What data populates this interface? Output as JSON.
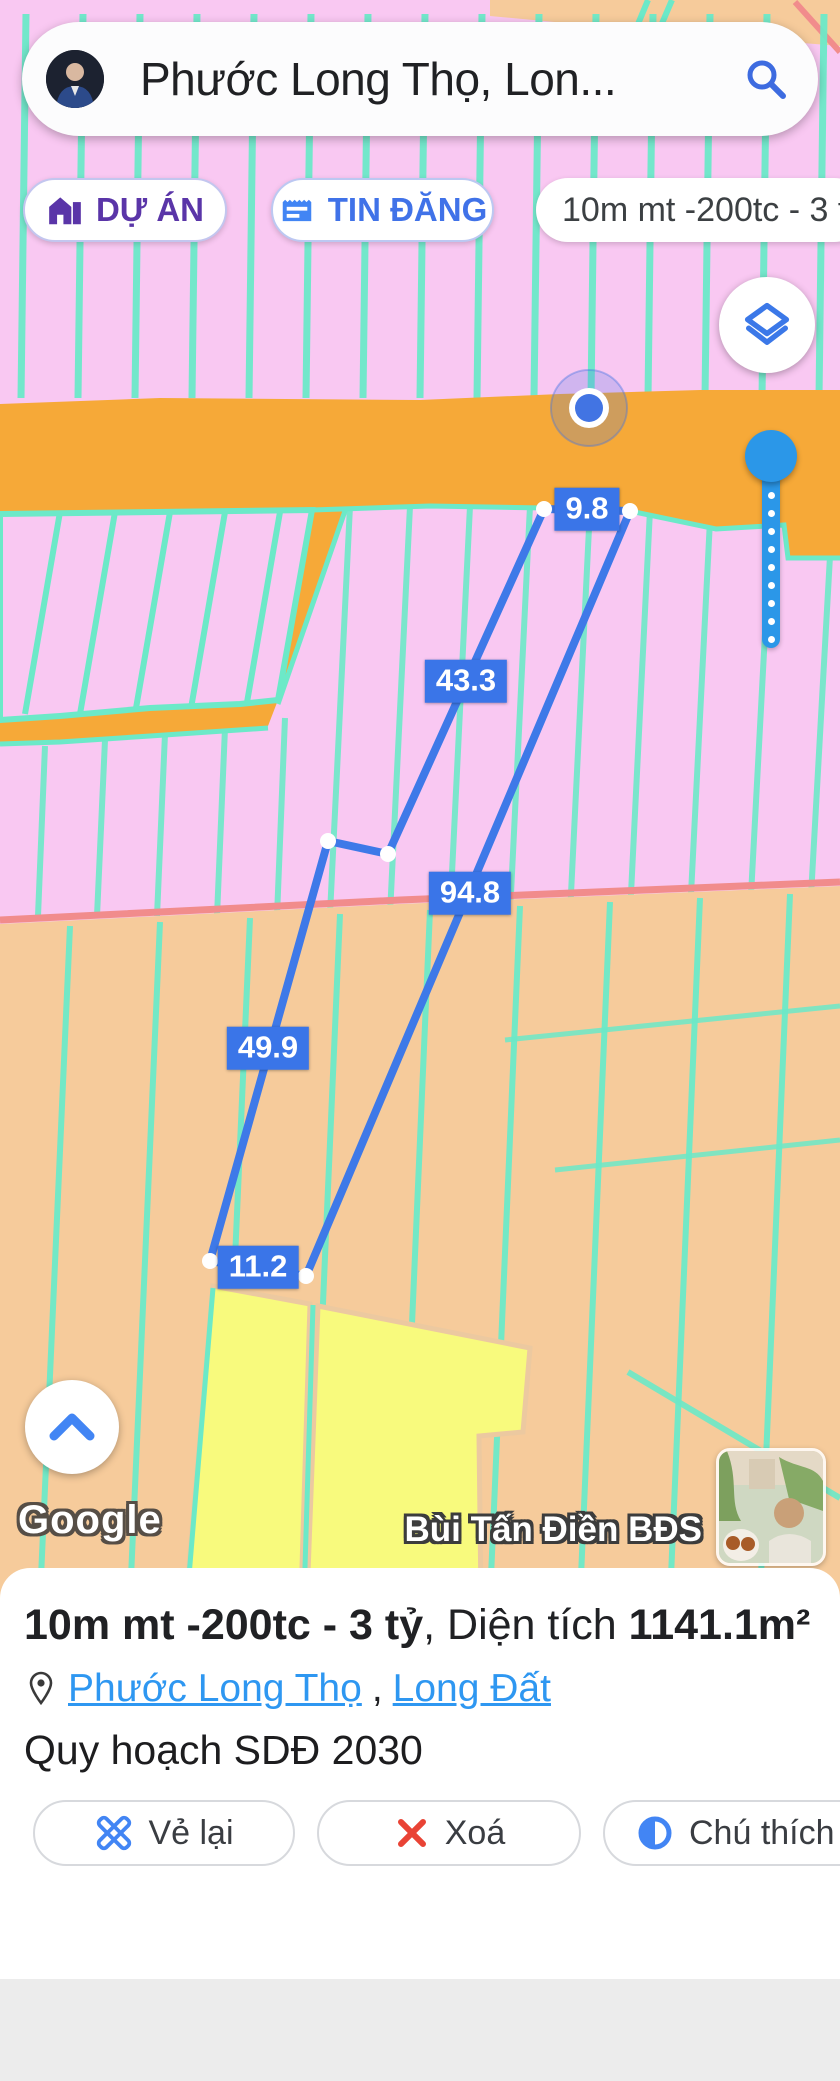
{
  "search": {
    "query": "Phước Long Thọ, Lon..."
  },
  "chips": {
    "project": {
      "label": "DỰ ÁN"
    },
    "listings": {
      "label": "TIN ĐĂNG"
    },
    "listing_info": {
      "label": "10m mt -200tc - 3 tỷ"
    }
  },
  "map": {
    "measurements": [
      {
        "label": "9.8",
        "x": 587,
        "y": 509
      },
      {
        "label": "43.3",
        "x": 466,
        "y": 681
      },
      {
        "label": "94.8",
        "x": 470,
        "y": 893
      },
      {
        "label": "49.9",
        "x": 268,
        "y": 1048
      },
      {
        "label": "11.2",
        "x": 258,
        "y": 1267
      }
    ],
    "google_watermark": "Google",
    "owner_watermark": "Bùi Tấn Điền BĐS",
    "colors": {
      "zone_pink": "#f9c8f2",
      "parcel_line_mint": "#6ce9c8",
      "road_orange": "#f6a938",
      "zone_tan": "#f6cb9b",
      "parcel_yellow": "#f8fa7d",
      "boundary_salmon": "#f18c8c",
      "measure_blue": "#3a75e8"
    }
  },
  "sheet": {
    "title_bold": "10m mt -200tc - 3 tỷ",
    "title_regular": ", Diện tích ",
    "area_value": "1141.1m²",
    "location": {
      "link1": "Phước Long Thọ",
      "separator": ",",
      "link2": "Long Đất"
    },
    "plan_label": "Quy hoạch SDĐ 2030",
    "buttons": [
      {
        "label": "Vẻ lại"
      },
      {
        "label": "Xoá"
      },
      {
        "label": "Chú thích"
      }
    ]
  }
}
